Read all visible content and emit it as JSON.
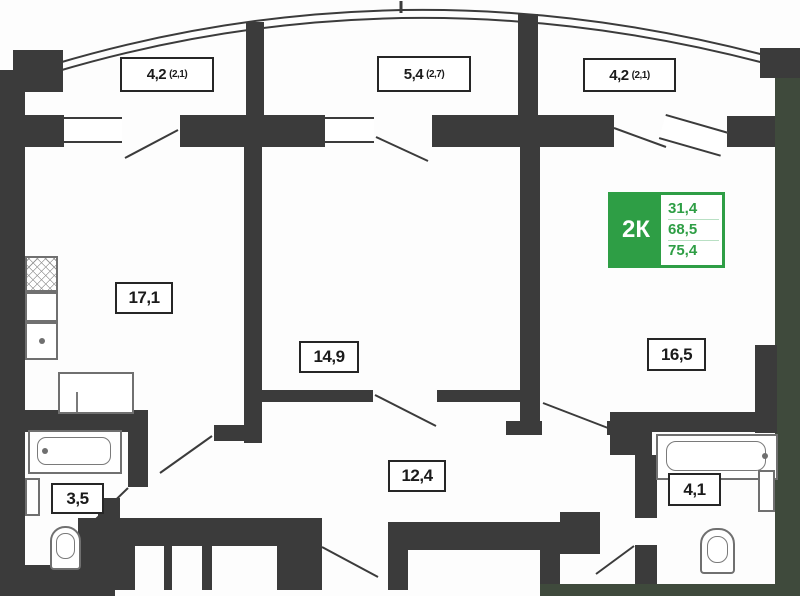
{
  "plan": {
    "badge": {
      "type": "2К",
      "values": [
        "31,4",
        "68,5",
        "75,4"
      ]
    },
    "balconies": [
      {
        "area": "4,2",
        "note": "(2,1)"
      },
      {
        "area": "5,4",
        "note": "(2,7)"
      },
      {
        "area": "4,2",
        "note": "(2,1)"
      }
    ],
    "rooms": {
      "kitchen_living": "17,1",
      "room_center": "14,9",
      "room_right": "16,5",
      "hallway": "12,4",
      "bath_left": "3,5",
      "bath_right": "4,1"
    },
    "colors": {
      "wall": "#3b3b3b",
      "accent_green": "#2e9e45",
      "outside_green": "#3f4a3c"
    }
  }
}
